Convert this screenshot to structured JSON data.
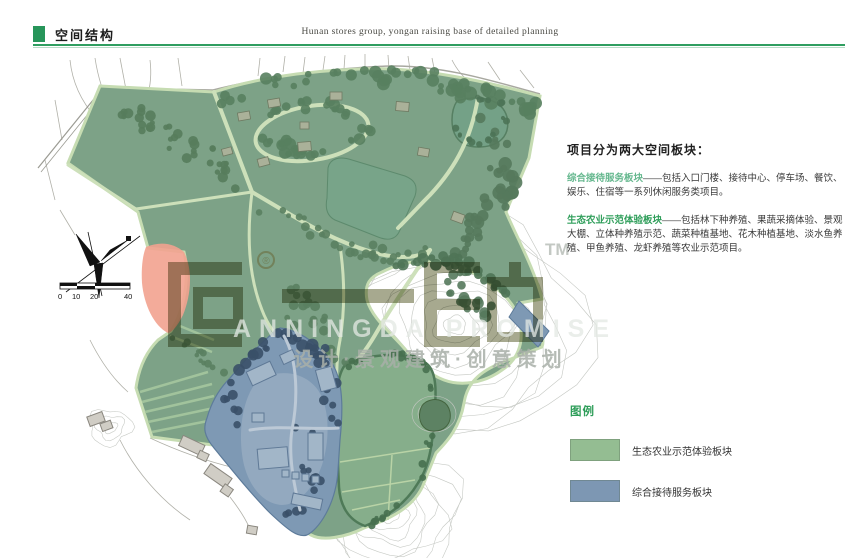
{
  "header": {
    "title": "空间结构",
    "subtitle": "Hunan stores group, yongan raising base of detailed planning",
    "accent_color": "#2f9e60"
  },
  "description": {
    "heading": "项目分为两大空间板块：",
    "blocks": [
      {
        "lead": "综合接待服务板块",
        "dash": "——",
        "body": "包括入口门楼、接待中心、停车场、餐饮、娱乐、住宿等一系列休闲服务类项目。",
        "lead_color": "#66b88f"
      },
      {
        "lead": "生态农业示范体验板块",
        "dash": "——",
        "body": "包括林下种养殖、果蔬采摘体验、景观大棚、立体种养殖示范、蔬菜种植基地、花木种植基地、淡水鱼养殖、甲鱼养殖、龙虾养殖等农业示范项目。",
        "lead_color": "#2f9e5a"
      }
    ]
  },
  "legend": {
    "title": "图例",
    "items": [
      {
        "label": "生态农业示范体验板块",
        "color": "#94bd92"
      },
      {
        "label": "综合接待服务板块",
        "color": "#7d97b3"
      }
    ]
  },
  "map": {
    "scale_bar": {
      "labels": [
        "0",
        "10",
        "20",
        "40"
      ]
    },
    "watermark": {
      "logo_text": "一诺",
      "reg_mark": "®",
      "tm_mark": "TM",
      "line1": "ANNINGDA PROMISE",
      "line2": "设计·景观建筑·创意策划"
    },
    "zone_colors": {
      "ecological_green": "#7da287",
      "reception_blue": "#7e99b4",
      "highlight_pink": "#f2a28f"
    }
  }
}
